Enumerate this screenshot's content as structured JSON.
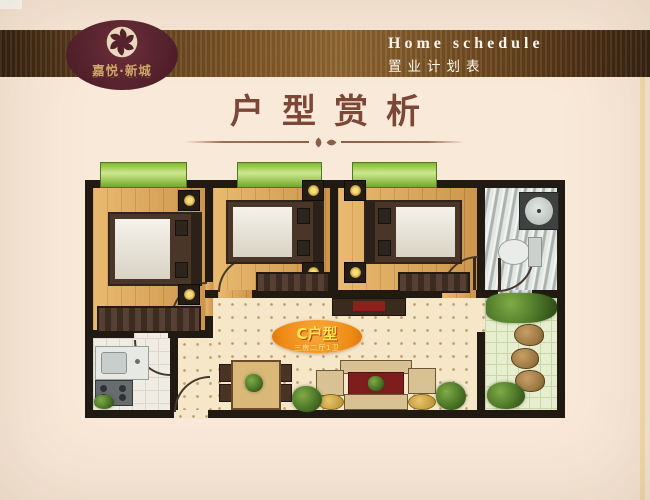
{
  "colors": {
    "background": "#f9e9d8",
    "band_brown": "#7d5526",
    "logo_maroon": "#5a2530",
    "brand_gold": "#c9a263",
    "title_brown": "#7c4737",
    "wall": "#211a12",
    "window_green": "#7fb832",
    "badge_orange": "#f18c1f",
    "badge_text_yellow": "#ffe94e",
    "wood_floor": "#dfa95c"
  },
  "header": {
    "title_en": "Home schedule",
    "title_cn": "置业计划表",
    "logo": {
      "brand": "嘉悦·新城",
      "tagline": "— · · — · · — · · —",
      "emblem_icon": "pinwheel-flower"
    }
  },
  "section": {
    "title": "户型赏析"
  },
  "floorplan": {
    "badge": {
      "label": "C户型",
      "subtitle": "三房二厅1卫"
    },
    "rooms": [
      "bedroom-1",
      "bedroom-2",
      "bedroom-3",
      "kitchen",
      "living-dining",
      "bathroom",
      "balcony"
    ]
  }
}
